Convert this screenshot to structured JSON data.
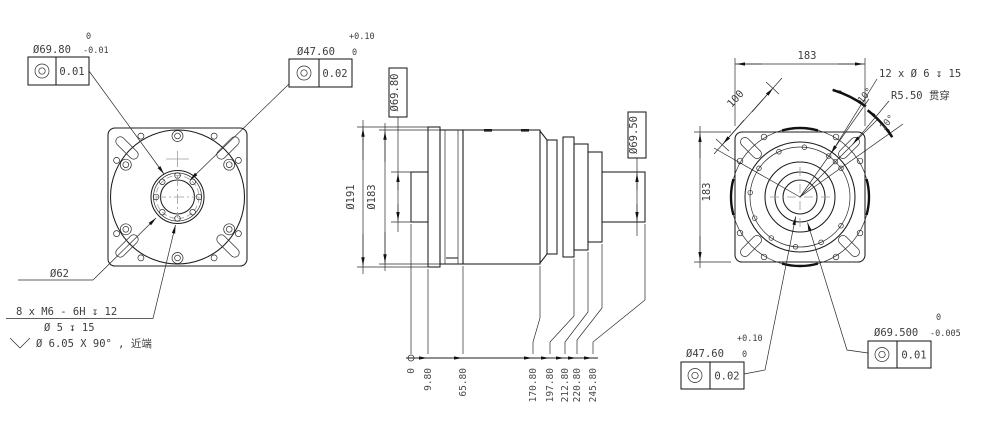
{
  "front": {
    "spigot_dia": "Ø69.80",
    "spigot_tol_up": "0",
    "spigot_tol_lo": "-0.01",
    "spigot_fcf": "0.01",
    "bore_dia": "Ø47.60",
    "bore_tol_up": "+0.10",
    "bore_tol_lo": "0",
    "bore_fcf": "0.02",
    "bolt_circle": "Ø62",
    "note1": "8 x  M6 - 6H ↧ 12",
    "note2": "Ø 5 ↧ 15",
    "note3": "Ø 6.05 X 90° , 近端"
  },
  "side": {
    "pilot_dia": "Ø69.80",
    "flange_dia": "Ø191",
    "body_dia": "Ø183",
    "shaft_dia": "Ø69.50",
    "ord": [
      "0",
      "9.80",
      "65.80",
      "170.80",
      "197.80",
      "212.80",
      "220.80",
      "245.80"
    ]
  },
  "rear": {
    "width": "183",
    "height": "183",
    "diag": "100",
    "holes": "12 x Ø 6 ↧ 15",
    "slot": "R5.50 贯穿",
    "ang1": "10°",
    "ang2": "10°",
    "bore_dia": "Ø47.60",
    "bore_tol_up": "+0.10",
    "bore_tol_lo": "0",
    "bore_fcf": "0.02",
    "spigot_dia": "Ø69.500",
    "spigot_tol_up": "0",
    "spigot_tol_lo": "-0.005",
    "spigot_fcf": "0.01"
  }
}
